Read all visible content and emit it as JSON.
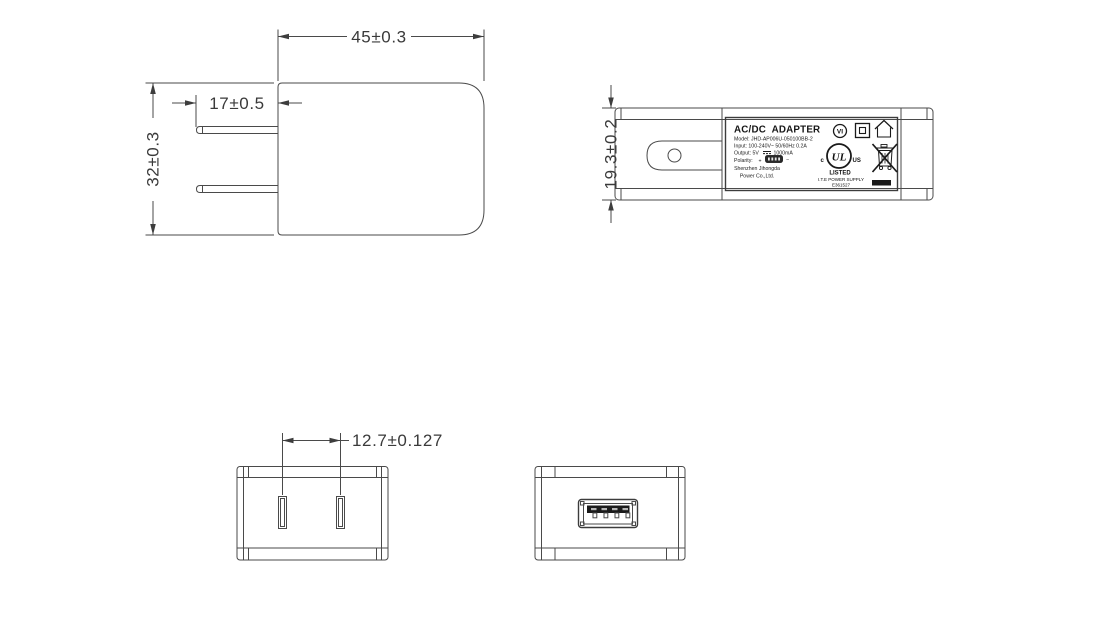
{
  "colors": {
    "background": "#ffffff",
    "line": "#4a4a4a",
    "dimension_text": "#3a3a3a",
    "label_ink": "#1a1a1a"
  },
  "front_view": {
    "dim_width": "45±0.3",
    "dim_pin_length": "17±0.5",
    "dim_height": "32±0.3"
  },
  "side_view": {
    "dim_thickness": "19.3±0.2",
    "label": {
      "title": "AC/DC  ADAPTER",
      "model_line": "Model: JHD-AP006U-050100BB-2",
      "input_line": "Input: 100-240V~ 50/60Hz 0.2A",
      "output_prefix": "Output: 5V",
      "output_suffix": "1000mA",
      "polarity_label": "Polarity:",
      "polarity_plus": "+",
      "polarity_minus": "−",
      "company_line1": "Shenzhen Jihongda",
      "company_line2": "Power Co.,Ltd.",
      "efficiency_mark": "VI",
      "ul_logo": "UL",
      "ul_c": "c",
      "ul_us": "US",
      "ul_listed": "LISTED",
      "ul_category": "I.T.E POWER SUPPLY",
      "ul_file_number": "E361527"
    }
  },
  "bottom_view": {
    "dim_pin_pitch": "12.7±0.127"
  },
  "icons": {
    "efficiency": "vi-efficiency-icon",
    "insulation": "class-ii-icon",
    "indoor": "indoor-use-icon",
    "safety": "ul-listed-icon",
    "recycling": "weee-bin-icon",
    "polarity": "usb-polarity-icon"
  }
}
